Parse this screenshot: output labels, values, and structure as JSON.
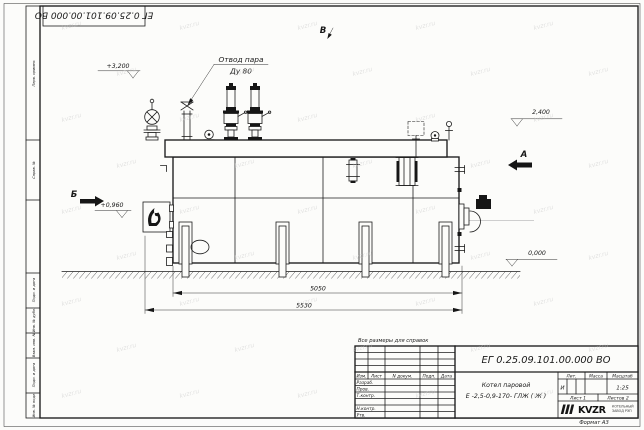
{
  "sheet": {
    "corner_stamp": "ЕГ 0.25.09.101.00.000  ВО",
    "reference_note": "Все размеры для справок",
    "format_label": "Формат А3",
    "paper_color": "#fcfcfa",
    "line_color": "#1c1c1c",
    "watermark_text": "kvzr.ru"
  },
  "margin_labels": [
    "Перв. примен.",
    "Справ. №",
    "Подп. и дата",
    "Инв. № дубл.",
    "Взам. инв. №",
    "Подп. и дата",
    "Инв. № подл."
  ],
  "title_block": {
    "doc_number": "ЕГ 0.25.09.101.00.000  ВО",
    "name_line1": "Котел паровой",
    "name_line2": "Е -2,5-0,9-170- ГЛЖ ( Ж )",
    "col_izm": "Изм.",
    "col_list": "Лист",
    "col_doc": "N докум.",
    "col_podp": "Подп.",
    "col_data": "Дата",
    "rows": [
      "Разраб.",
      "Пров.",
      "Т.контр.",
      "",
      "Н.контр.",
      "Утв."
    ],
    "col_lit": "Лит.",
    "col_massa": "Масса",
    "col_scale": "Масштаб",
    "lit_value": "И",
    "scale_value": "1:25",
    "sheet_label": "Лист 1",
    "sheets_label": "Листов 2",
    "logo_text": "KVZR",
    "org_line1": "КОТЕЛЬНЫЙ",
    "org_line2": "ЗАВОД РЭП"
  },
  "annotations": {
    "steam_outlet_line1": "Отвод пара",
    "steam_outlet_line2": "Ду 80",
    "elev_top": "+3,200",
    "elev_right": "2,400",
    "elev_burner": "+0,960",
    "elev_zero": "0,000",
    "dim_inner": "5050",
    "dim_overall": "5530",
    "view_a": "А",
    "view_b": "Б",
    "view_v": "В"
  }
}
